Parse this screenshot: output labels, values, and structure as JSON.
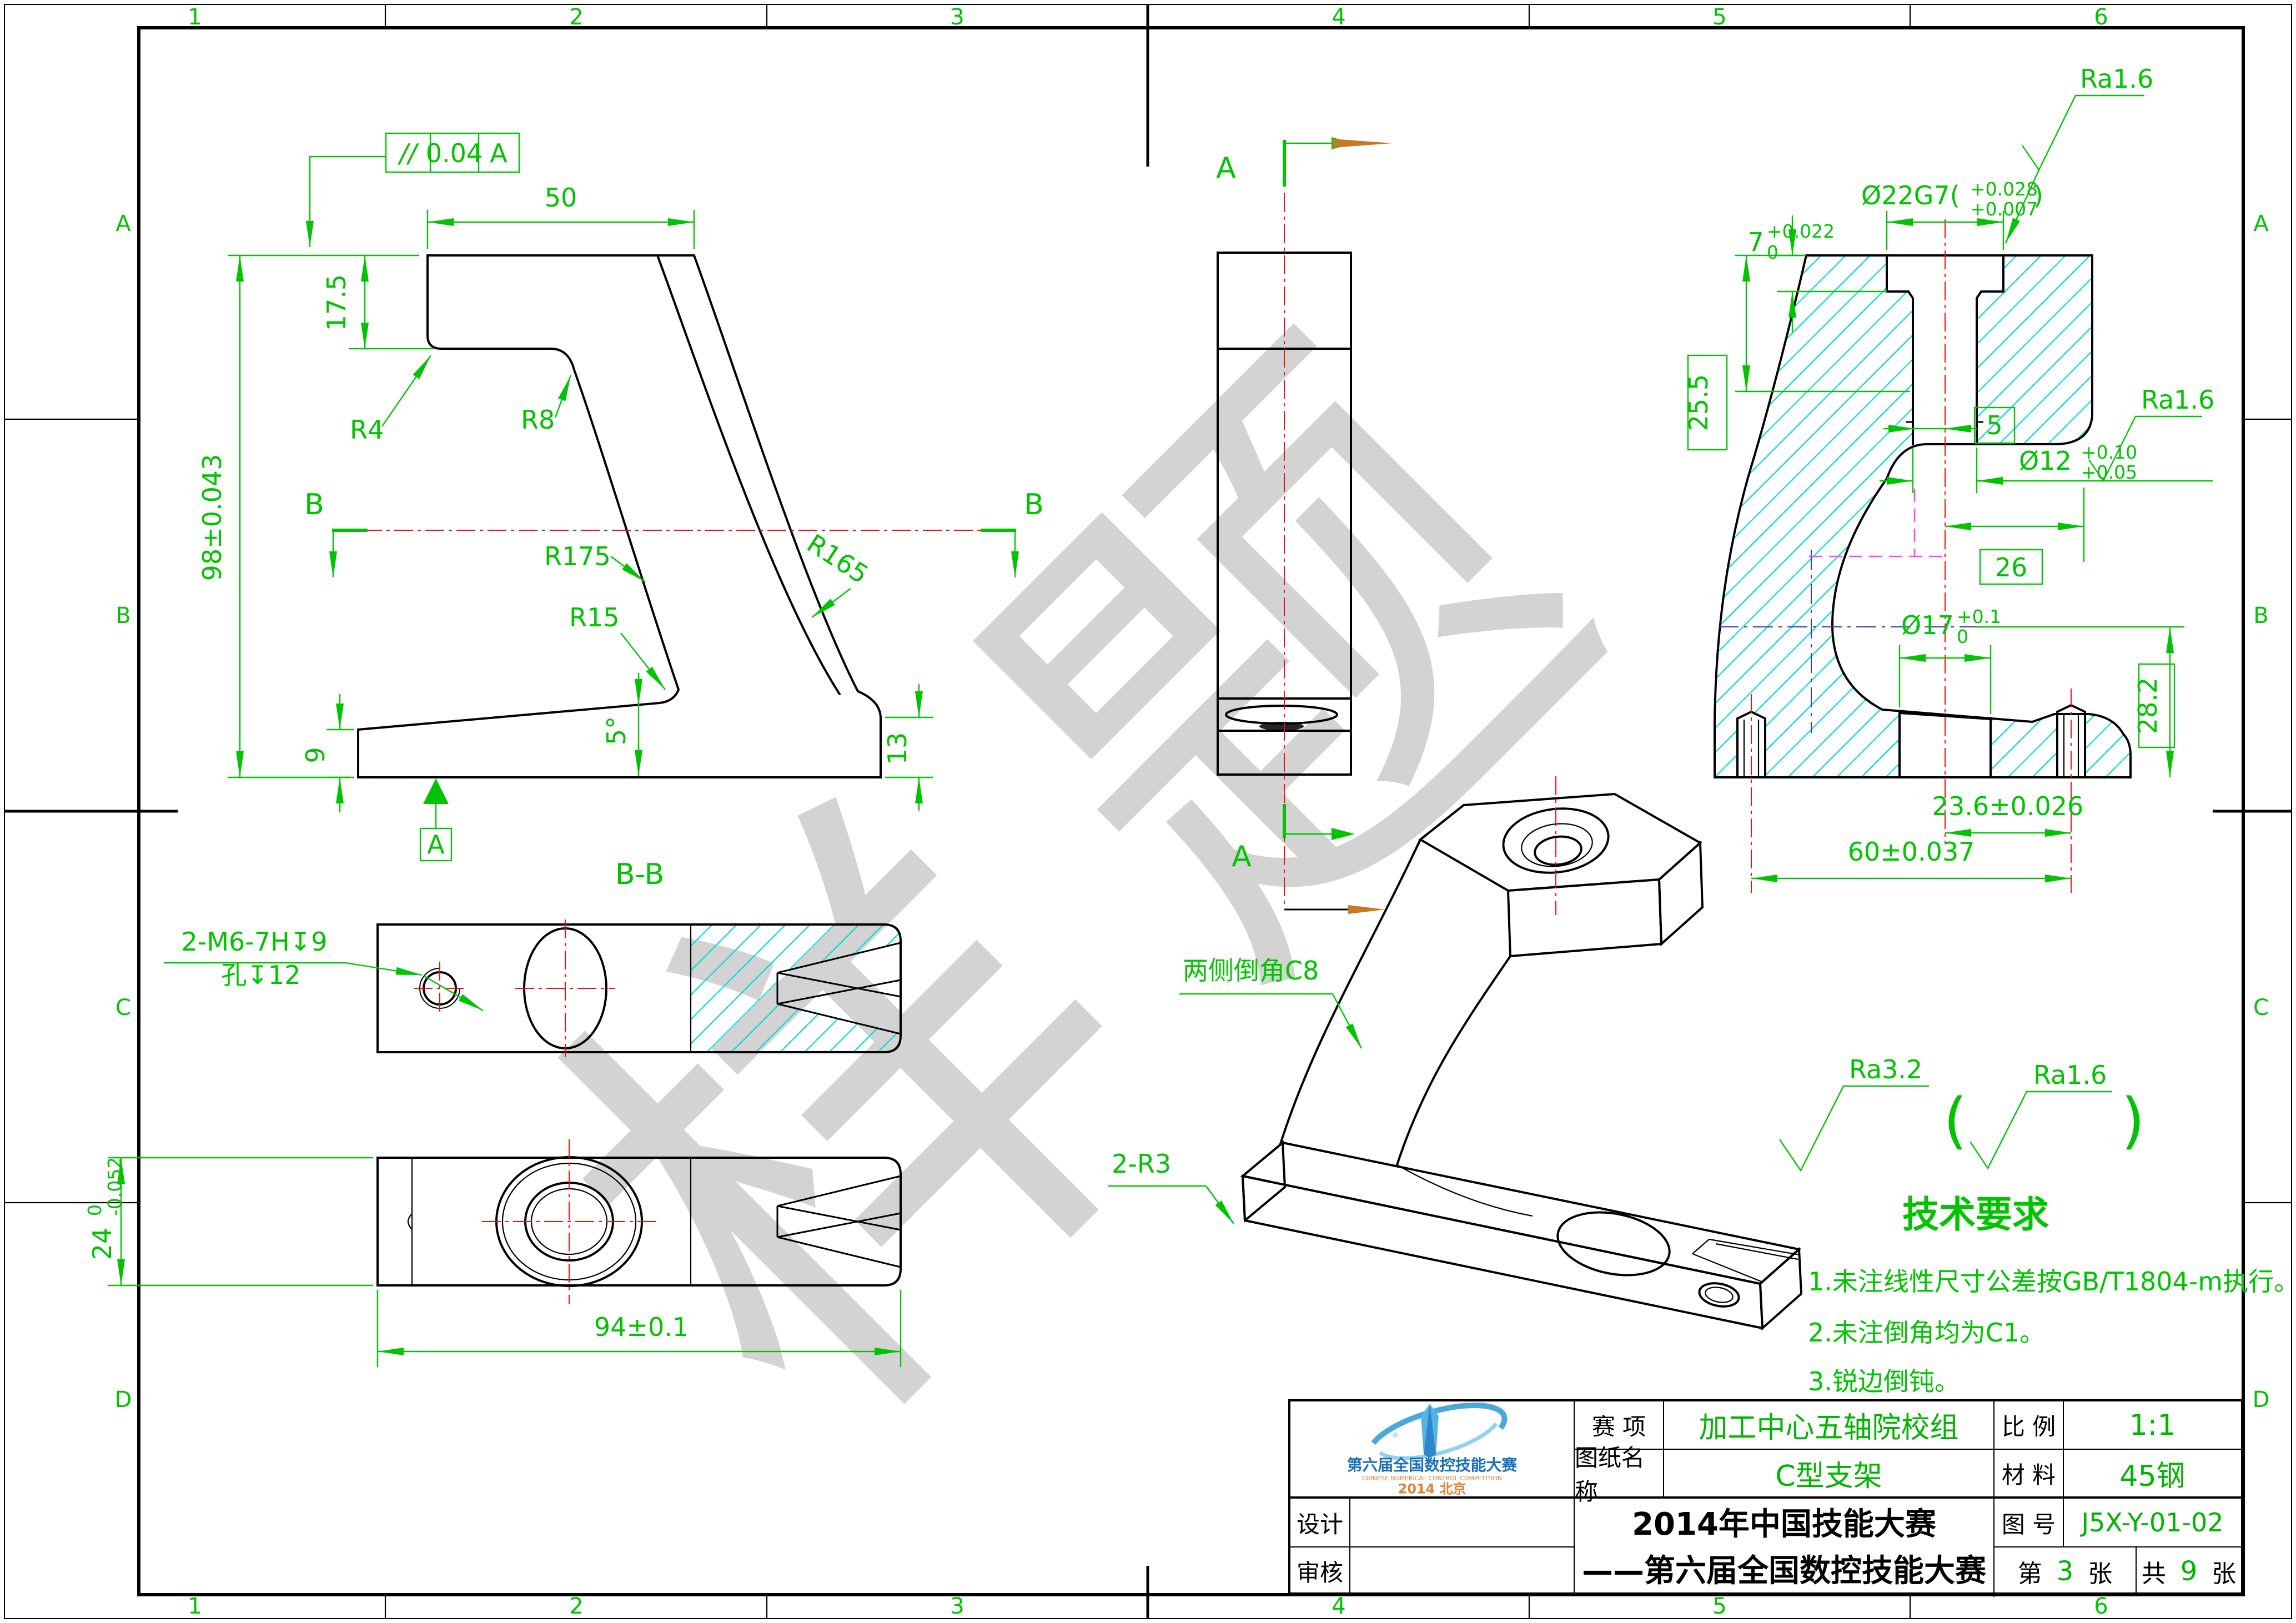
{
  "watermark": {
    "char1": "样",
    "char2": "题"
  },
  "frame": {
    "cols": [
      "1",
      "2",
      "3",
      "4",
      "5",
      "6"
    ],
    "rows": [
      "A",
      "B",
      "C",
      "D"
    ]
  },
  "front": {
    "tol_sym": "//",
    "tol_val": "0.04",
    "tol_datum": "A",
    "w50": "50",
    "h175": "17.5",
    "r4": "R4",
    "r8": "R8",
    "r175": "R175",
    "r165": "R165",
    "h98": "98±0.043",
    "r15": "R15",
    "h9": "9",
    "ang5": "5°",
    "h13": "13",
    "datum": "A",
    "sec_l": "B",
    "sec_r": "B"
  },
  "side": {
    "arrow_top": "A",
    "arrow_bot": "A"
  },
  "aa": {
    "ra1": "Ra1.6",
    "ra2": "Ra1.6",
    "d22": "Ø22G7(",
    "d22u": "+0.028",
    "d22l": "+0.007",
    "d22c": ")",
    "h7": "7",
    "h7u": "+0.022",
    "h7l": "0",
    "h255": "25.5",
    "d12": "Ø12",
    "d12u": "+0.10",
    "d12l": "+0.05",
    "b5": "5",
    "b26": "26",
    "d17": "Ø17",
    "d17u": "+0.1",
    "d17l": "0",
    "h282": "28.2",
    "w236": "23.6±0.026",
    "w60": "60±0.037"
  },
  "bb": {
    "title": "B-B",
    "callout1": "2-M6-7H↧9",
    "callout2": "孔↧12"
  },
  "plan": {
    "w24": "24",
    "w24u": "0",
    "w24l": "-0.052",
    "w94": "94±0.1"
  },
  "iso": {
    "chamfer": "两侧倒角C8",
    "r3": "2-R3"
  },
  "tech": {
    "ra_main": "Ra3.2",
    "par_l": "(",
    "ra_par": "Ra1.6",
    "par_r": ")",
    "title": "技术要求",
    "item1": "1.未注线性尺寸公差按GB/T1804-m执行。",
    "item2": "2.未注倒角均为C1。",
    "item3": "3.锐边倒钝。"
  },
  "tb": {
    "l_event": "赛  项",
    "v_event": "加工中心五轴院校组",
    "l_scale": "比 例",
    "v_scale": "1:1",
    "l_name": "图纸名称",
    "v_name": "C型支架",
    "l_mat": "材 料",
    "v_mat": "45钢",
    "l_design": "设计",
    "l_audit": "审核",
    "big1": "2014年中国技能大赛",
    "big2": "——第六届全国数控技能大赛",
    "l_no": "图 号",
    "v_no": "J5X-Y-01-02",
    "sheet_pre": "第",
    "sheet_n": "3",
    "sheet_mid": "张",
    "total_pre": "共",
    "total_n": "9",
    "total_post": "张"
  },
  "logo": {
    "line1": "第六届全国数控技能大赛",
    "line2": "CHINESE NUMERICAL CONTROL COMPETITION",
    "line3": "2014 北京"
  }
}
